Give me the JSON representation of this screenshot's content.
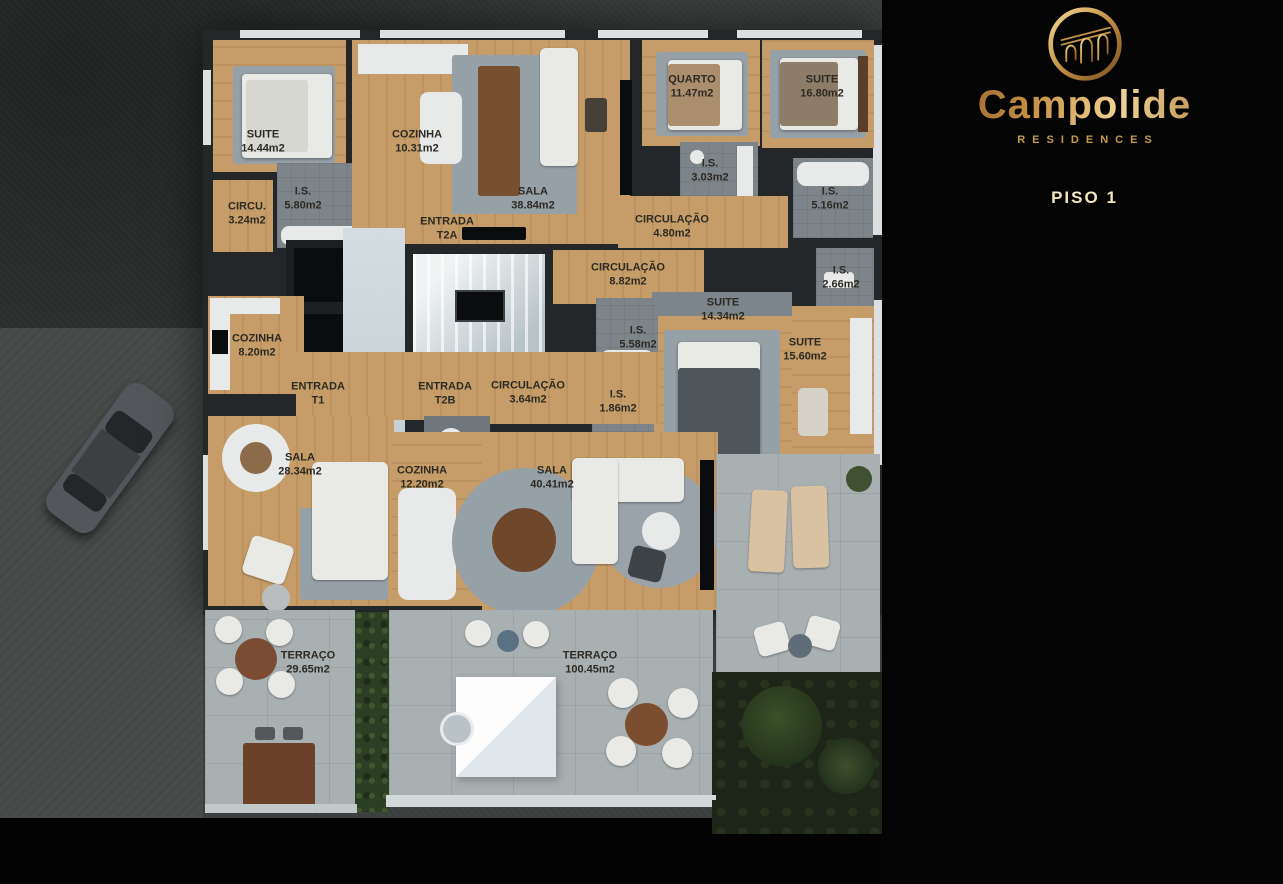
{
  "brand": {
    "name": "Campolide",
    "subtitle": "RESIDENCES"
  },
  "panel": {
    "floor_title": "PISO 1",
    "footnote": "*ABC :  ÁREA APARTAMENTO + VARANDAS + ARRECADAÇÃO",
    "units": [
      {
        "id": "T2A",
        "badge_main": "T2",
        "badge_sub": "A",
        "rows": [
          {
            "icon": "floorplan-doc-icon",
            "text": "ÁREA DE CONSTRUÇÃO BRUTA :  112.85 m2*"
          },
          {
            "icon": "bed-icon",
            "text": "1 QUARTO + 1 SUITE"
          },
          {
            "icon": "shower-icon",
            "text": "2 INSTALAÇÕES SANITÁRIAS"
          },
          {
            "icon": "car-garage-icon",
            "text": "2 LUGARES ESTACIONAMENTO"
          }
        ]
      },
      {
        "id": "T2B",
        "badge_main": "T2",
        "badge_sub": "B",
        "rows": [
          {
            "icon": "floorplan-doc-icon",
            "text": "ÁREA DE CONSTRUÇÃO BRUTA :  240.55 m2*"
          },
          {
            "icon": "bed-icon",
            "text": "2 SUITES"
          },
          {
            "icon": "shower-icon",
            "text": "3 INSTALAÇÕES SANITÁRIAS"
          },
          {
            "icon": "car-garage-icon",
            "text": "2 LUGARES ESTACIONAMENTO"
          }
        ]
      },
      {
        "id": "T1",
        "badge_main": "T1",
        "badge_sub": "",
        "rows": [
          {
            "icon": "floorplan-doc-icon",
            "text": "ÁREA DE CONSTRUÇÃO BRUTA :  110.70m2*"
          },
          {
            "icon": "bed-icon",
            "text": "1 SUITE"
          },
          {
            "icon": "shower-icon",
            "text": "1 INSTALAÇÃO SANITÁRIA"
          },
          {
            "icon": "car-garage-icon",
            "text": "2 LUGARES ESTACIONAMENTO"
          }
        ]
      }
    ]
  },
  "floorplan": {
    "rooms": [
      {
        "name": "SUITE",
        "area": "14.44m2",
        "x": 263,
        "y": 142
      },
      {
        "name": "COZINHA",
        "area": "10.31m2",
        "x": 417,
        "y": 142
      },
      {
        "name": "SALA",
        "area": "38.84m2",
        "x": 533,
        "y": 199
      },
      {
        "name": "I.S.",
        "area": "5.80m2",
        "x": 303,
        "y": 199
      },
      {
        "name": "CIRCU.",
        "area": "3.24m2",
        "x": 247,
        "y": 214
      },
      {
        "name": "ENTRADA",
        "area": "T2A",
        "x": 447,
        "y": 229
      },
      {
        "name": "QUARTO",
        "area": "11.47m2",
        "x": 692,
        "y": 87
      },
      {
        "name": "SUITE",
        "area": "16.80m2",
        "x": 822,
        "y": 87
      },
      {
        "name": "I.S.",
        "area": "3.03m2",
        "x": 710,
        "y": 171
      },
      {
        "name": "I.S.",
        "area": "5.16m2",
        "x": 830,
        "y": 199
      },
      {
        "name": "CIRCULAÇÃO",
        "area": "4.80m2",
        "x": 672,
        "y": 227
      },
      {
        "name": "CIRCULAÇÃO",
        "area": "8.82m2",
        "x": 628,
        "y": 275
      },
      {
        "name": "I.S.",
        "area": "2.66m2",
        "x": 841,
        "y": 278
      },
      {
        "name": "SUITE",
        "area": "14.34m2",
        "x": 723,
        "y": 310
      },
      {
        "name": "I.S.",
        "area": "5.58m2",
        "x": 638,
        "y": 338
      },
      {
        "name": "SUITE",
        "area": "15.60m2",
        "x": 805,
        "y": 350
      },
      {
        "name": "COZINHA",
        "area": "8.20m2",
        "x": 257,
        "y": 346
      },
      {
        "name": "ENTRADA",
        "area": "T1",
        "x": 318,
        "y": 394
      },
      {
        "name": "ENTRADA",
        "area": "T2B",
        "x": 445,
        "y": 394
      },
      {
        "name": "CIRCULAÇÃO",
        "area": "3.64m2",
        "x": 528,
        "y": 393
      },
      {
        "name": "I.S.",
        "area": "1.86m2",
        "x": 618,
        "y": 402
      },
      {
        "name": "SALA",
        "area": "28.34m2",
        "x": 300,
        "y": 465
      },
      {
        "name": "COZINHA",
        "area": "12.20m2",
        "x": 422,
        "y": 478
      },
      {
        "name": "SALA",
        "area": "40.41m2",
        "x": 552,
        "y": 478
      },
      {
        "name": "TERRAÇO",
        "area": "29.65m2",
        "x": 308,
        "y": 663
      },
      {
        "name": "TERRAÇO",
        "area": "100.45m2",
        "x": 590,
        "y": 663
      }
    ]
  },
  "colors": {
    "gold": "#c49a52",
    "pale_gold": "#e3d992",
    "wood": "#c69d68",
    "concrete": "#a9b0b2"
  }
}
